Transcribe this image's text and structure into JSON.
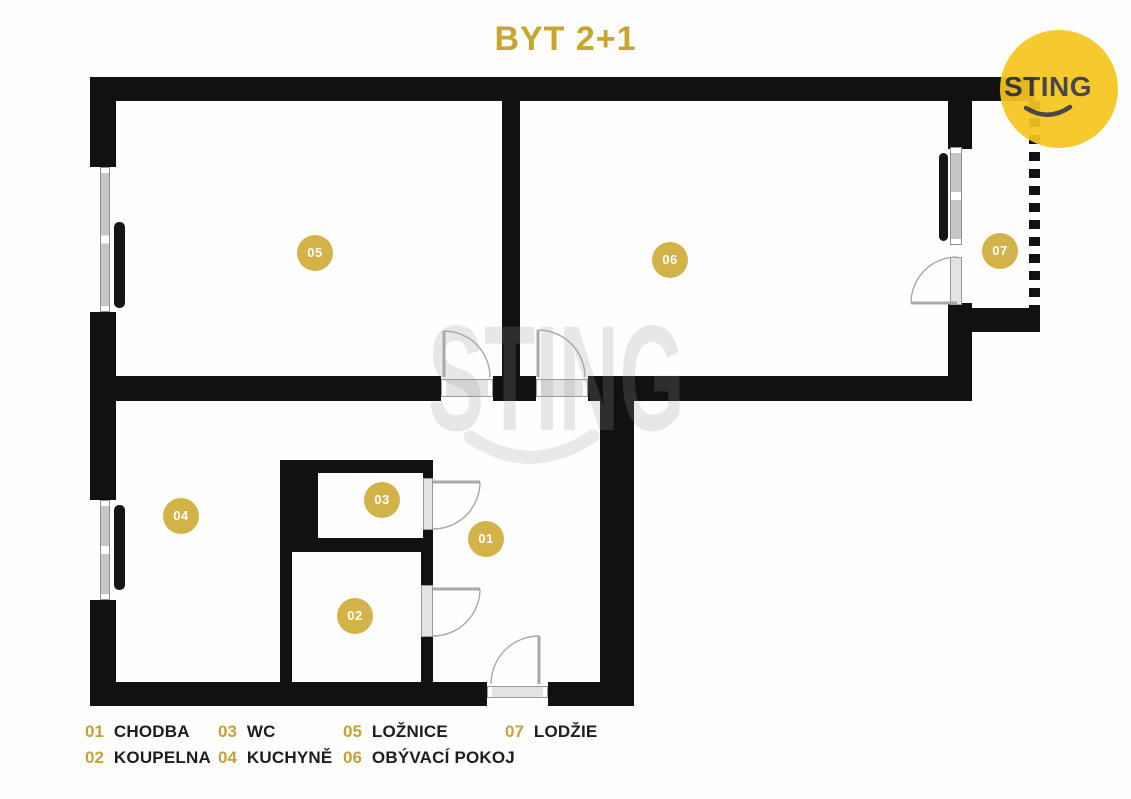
{
  "title": "BYT 2+1",
  "logo": {
    "text": "STING"
  },
  "watermark": {
    "text": "STING"
  },
  "rooms": [
    {
      "number": "01",
      "label": "CHODBA"
    },
    {
      "number": "02",
      "label": "KOUPELNA"
    },
    {
      "number": "03",
      "label": "WC"
    },
    {
      "number": "04",
      "label": "KUCHYNĚ"
    },
    {
      "number": "05",
      "label": "LOŽNICE"
    },
    {
      "number": "06",
      "label": "OBÝVACÍ POKOJ"
    },
    {
      "number": "07",
      "label": "LODŽIE"
    }
  ],
  "colors": {
    "title_gold": "#c7a52f",
    "badge_gold": "#d3b348",
    "legend_number_gold": "#c2a23d",
    "logo_yellow": "#f6c51f",
    "wall_black": "#111111"
  }
}
